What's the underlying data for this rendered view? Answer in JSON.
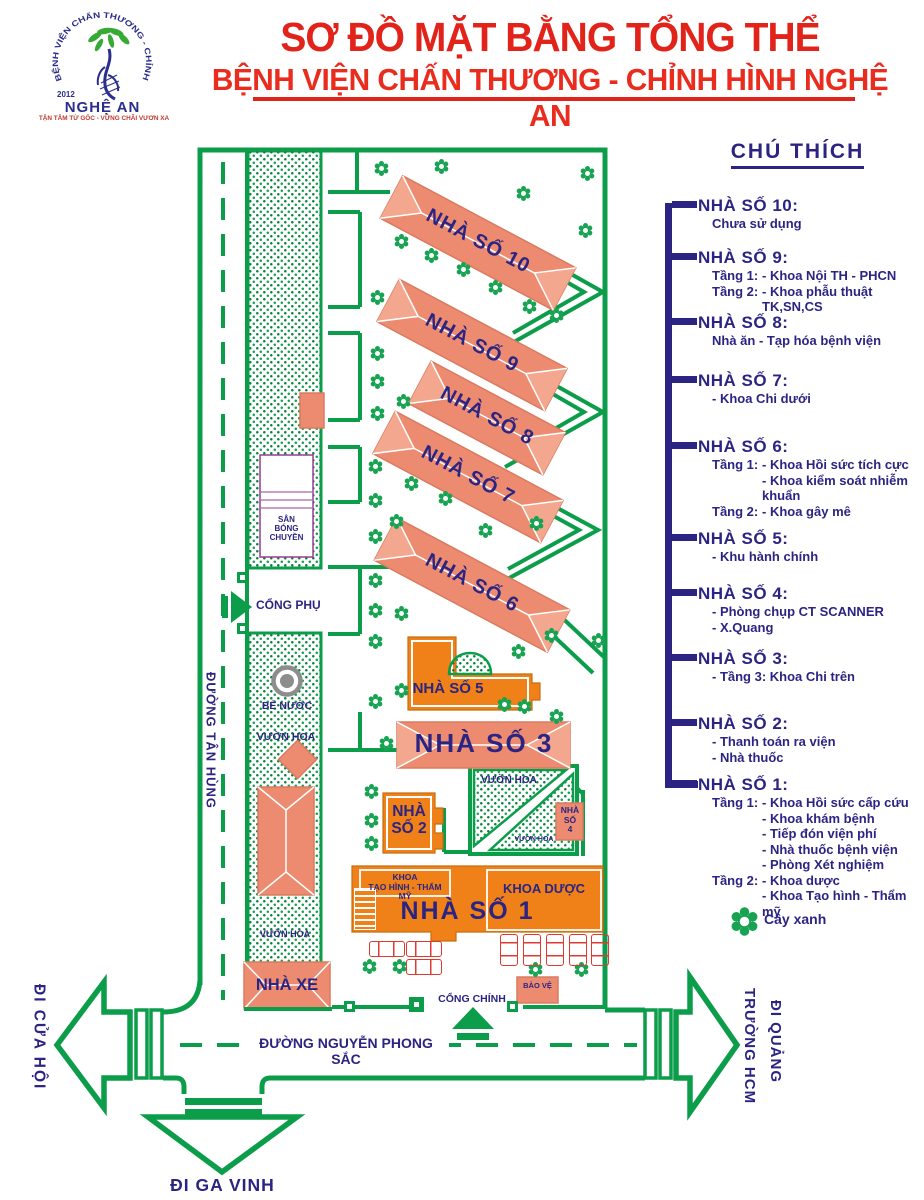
{
  "header": {
    "title1": "SƠ ĐỒ MẶT BẰNG TỔNG THỂ",
    "title2": "BỆNH VIỆN CHẤN THƯƠNG - CHỈNH HÌNH NGHỆ AN",
    "logo": {
      "arc_text": "BỆNH VIỆN CHẤN THƯƠNG - CHỈNH HÌNH",
      "year": "2012",
      "region": "NGHỆ AN",
      "tagline": "TẬN TÂM TỪ GỐC - VỮNG CHÃI VƯƠN XA"
    }
  },
  "legend": {
    "title": "CHÚ THÍCH",
    "tree_label": "Cây xanh",
    "items": [
      {
        "name": "NHÀ SỐ 10:",
        "y": 196,
        "lines": [
          {
            "txt": "Chưa sử dụng"
          }
        ]
      },
      {
        "name": "NHÀ SỐ 9:",
        "y": 248,
        "lines": [
          {
            "pre": "Tầng 1:",
            "txt": "- Khoa Nội TH - PHCN"
          },
          {
            "pre": "Tầng 2:",
            "txt": "- Khoa phẫu thuật TK,SN,CS"
          }
        ]
      },
      {
        "name": "NHÀ SỐ 8:",
        "y": 313,
        "lines": [
          {
            "txt": "Nhà ăn - Tạp hóa bệnh viện"
          }
        ]
      },
      {
        "name": "NHÀ SỐ 7:",
        "y": 371,
        "lines": [
          {
            "txt": "- Khoa Chi dưới"
          }
        ]
      },
      {
        "name": "NHÀ SỐ 6:",
        "y": 437,
        "lines": [
          {
            "pre": "Tầng 1:",
            "txt": "- Khoa Hồi sức tích cực"
          },
          {
            "ind": true,
            "txt": "- Khoa kiểm soát nhiễm khuẩn"
          },
          {
            "pre": "Tầng 2:",
            "txt": "- Khoa gây mê"
          }
        ]
      },
      {
        "name": "NHÀ SỐ 5:",
        "y": 529,
        "lines": [
          {
            "txt": "- Khu hành chính"
          }
        ]
      },
      {
        "name": "NHÀ SỐ 4:",
        "y": 584,
        "lines": [
          {
            "txt": "- Phòng chụp CT SCANNER"
          },
          {
            "txt": "- X.Quang"
          }
        ]
      },
      {
        "name": "NHÀ SỐ 3:",
        "y": 649,
        "lines": [
          {
            "txt": "- Tầng 3: Khoa Chi trên"
          }
        ]
      },
      {
        "name": "NHÀ SỐ 2:",
        "y": 714,
        "lines": [
          {
            "txt": "- Thanh toán ra viện"
          },
          {
            "txt": "- Nhà thuốc"
          }
        ]
      },
      {
        "name": "NHÀ SỐ 1:",
        "y": 775,
        "lines": [
          {
            "pre": "Tầng 1:",
            "txt": "- Khoa Hồi sức cấp cứu"
          },
          {
            "ind": true,
            "txt": "- Khoa khám bệnh"
          },
          {
            "ind": true,
            "txt": "- Tiếp đón viện phí"
          },
          {
            "ind": true,
            "txt": "- Nhà thuốc bệnh viện"
          },
          {
            "ind": true,
            "txt": "- Phòng Xét nghiệm"
          },
          {
            "pre": "Tầng 2:",
            "txt": "- Khoa dược"
          },
          {
            "ind": true,
            "txt": "- Khoa Tạo hình - Thẩm mỹ"
          }
        ]
      }
    ]
  },
  "map": {
    "labels": {
      "tan_hung": "ĐƯỜNG TÂN HÙNG",
      "cong_phu": "CỔNG PHỤ",
      "cong_chinh": "CỔNG CHÍNH",
      "be_nuoc": "BỂ NƯỚC",
      "san_bong_1": "SÂN",
      "san_bong_2": "BÓNG CHUYỀN",
      "vuon_hoa": "VƯỜN HOA",
      "nha_xe": "NHÀ XE",
      "bao_ve": "BẢO VỆ",
      "khoa_duoc": "KHOA DƯỢC",
      "khoa_th_1": "KHOA",
      "khoa_th_2": "TẠO HÌNH - THẨM MỸ",
      "nha_so_1": "NHÀ SỐ 1",
      "nha_so_2a": "NHÀ",
      "nha_so_2b": "SỐ 2",
      "nha_so_3": "NHÀ SỐ 3",
      "nha_so_4a": "NHÀ",
      "nha_so_4b": "SỐ",
      "nha_so_4c": "4",
      "nha_so_5": "NHÀ SỐ 5",
      "nguyen_phong_sac": "ĐƯỜNG NGUYỄN PHONG SẮC",
      "di_cua_hoi": "ĐI CỬA HỘI",
      "di_ga_vinh": "ĐI GA VINH",
      "di_quang_1": "ĐI QUẢNG",
      "di_quang_2": "TRƯỜNG HCM"
    },
    "diagonal_buildings": [
      {
        "label": "NHÀ SỐ 10",
        "cx": 478,
        "cy": 243,
        "len": 196
      },
      {
        "label": "NHÀ SỐ 9",
        "cx": 472,
        "cy": 345,
        "len": 190
      },
      {
        "label": "NHÀ SỐ 8",
        "cx": 487,
        "cy": 418,
        "len": 152
      },
      {
        "label": "NHÀ SỐ 7",
        "cx": 468,
        "cy": 477,
        "len": 190
      },
      {
        "label": "NHÀ SỐ 6",
        "cx": 472,
        "cy": 585,
        "len": 196
      }
    ],
    "trees": [
      [
        378,
        165
      ],
      [
        438,
        163
      ],
      [
        520,
        190
      ],
      [
        584,
        170
      ],
      [
        582,
        227
      ],
      [
        398,
        238
      ],
      [
        428,
        252
      ],
      [
        460,
        266
      ],
      [
        492,
        284
      ],
      [
        526,
        303
      ],
      [
        553,
        312
      ],
      [
        374,
        294
      ],
      [
        374,
        350
      ],
      [
        374,
        378
      ],
      [
        400,
        398
      ],
      [
        374,
        410
      ],
      [
        372,
        463
      ],
      [
        408,
        480
      ],
      [
        372,
        497
      ],
      [
        442,
        495
      ],
      [
        393,
        518
      ],
      [
        372,
        533
      ],
      [
        482,
        527
      ],
      [
        533,
        520
      ],
      [
        372,
        577
      ],
      [
        372,
        607
      ],
      [
        398,
        610
      ],
      [
        372,
        638
      ],
      [
        398,
        687
      ],
      [
        372,
        698
      ],
      [
        515,
        648
      ],
      [
        548,
        632
      ],
      [
        595,
        637
      ],
      [
        501,
        701
      ],
      [
        521,
        703
      ],
      [
        553,
        713
      ],
      [
        383,
        740
      ],
      [
        368,
        788
      ],
      [
        368,
        817
      ],
      [
        368,
        840
      ],
      [
        366,
        963
      ],
      [
        396,
        963
      ],
      [
        532,
        966
      ],
      [
        578,
        966
      ]
    ],
    "cars_h": [
      [
        369,
        941
      ],
      [
        406,
        941
      ],
      [
        406,
        959
      ]
    ],
    "cars_v": [
      [
        500,
        934
      ],
      [
        523,
        934
      ],
      [
        546,
        934
      ],
      [
        569,
        934
      ],
      [
        591,
        934
      ]
    ]
  },
  "colors": {
    "green": "#0C9D4B",
    "salmon": "#EC8B70",
    "salmon_light": "#F4A78F",
    "orange": "#F08119",
    "navy": "#2B2483",
    "red": "#E2231A"
  }
}
